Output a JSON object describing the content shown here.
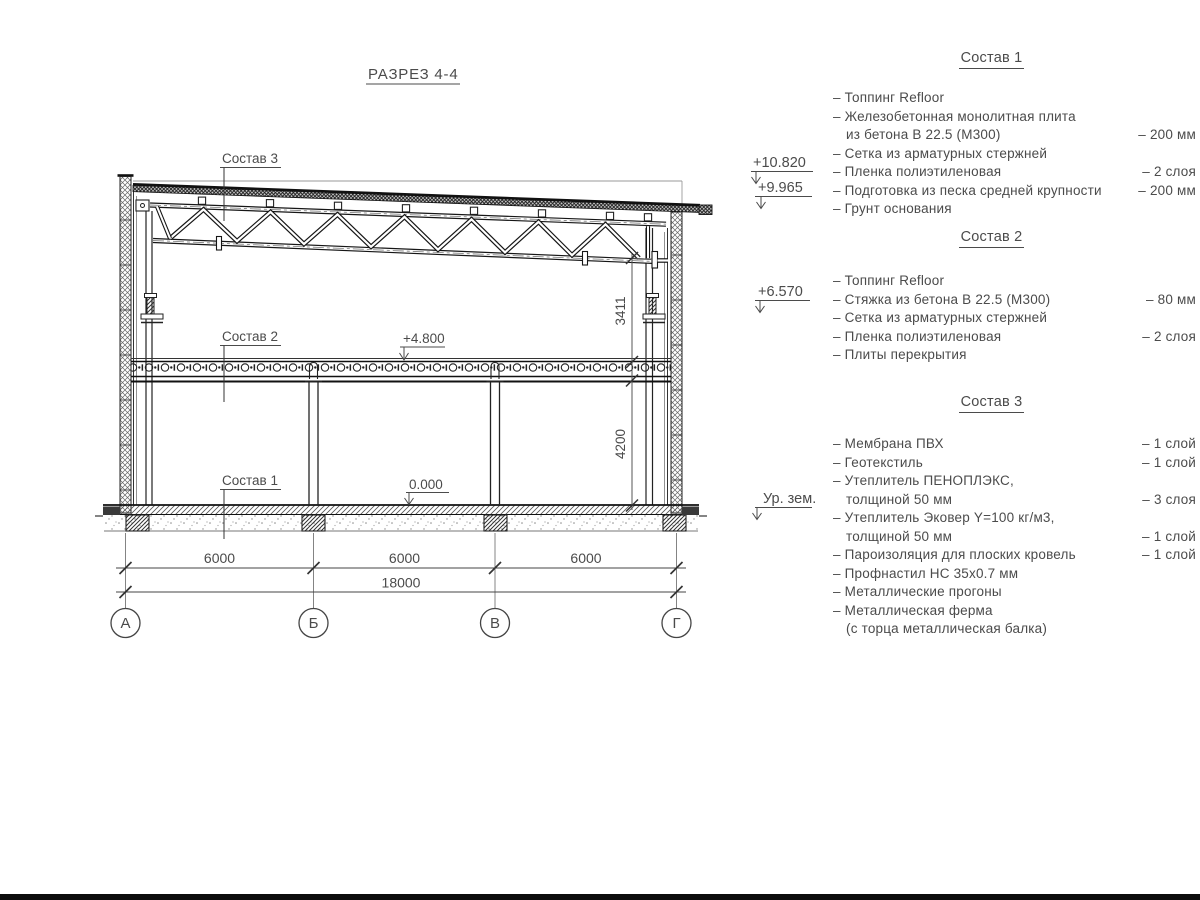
{
  "title": "РАЗРЕЗ 4-4",
  "drawing": {
    "callouts": {
      "sostav3": "Состав 3",
      "sostav2": "Состав 2",
      "sostav1": "Состав 1"
    },
    "elevations": {
      "parapet": "+10.820",
      "roof_edge": "+9.965",
      "console": "+6.570",
      "floor2": "+4.800",
      "floor1": "0.000",
      "ground": "Ур. зем."
    },
    "dims": {
      "span1": "6000",
      "span2": "6000",
      "span3": "6000",
      "total": "18000",
      "h_upper": "3411",
      "h_lower": "4200"
    },
    "axes": [
      "А",
      "Б",
      "В",
      "Г"
    ]
  },
  "lists": [
    {
      "heading": "Состав 1",
      "rows": [
        {
          "l": "– Топпинг Refloor",
          "r": ""
        },
        {
          "l": "– Железобетонная  монолитная плита",
          "r": ""
        },
        {
          "l": "из бетона В 22.5 (М300)",
          "r": "– 200 мм"
        },
        {
          "l": "– Сетка из арматурных стержней",
          "r": ""
        },
        {
          "l": "– Пленка полиэтиленовая",
          "r": "– 2 слоя"
        },
        {
          "l": "– Подготовка из песка средней крупности",
          "r": "– 200 мм"
        },
        {
          "l": "– Грунт основания",
          "r": ""
        }
      ]
    },
    {
      "heading": "Состав 2",
      "rows": [
        {
          "l": "– Топпинг Refloor",
          "r": ""
        },
        {
          "l": "– Стяжка из бетона В 22.5 (М300)",
          "r": "– 80 мм"
        },
        {
          "l": "– Сетка из арматурных стержней",
          "r": ""
        },
        {
          "l": "– Пленка полиэтиленовая",
          "r": "– 2 слоя"
        },
        {
          "l": "– Плиты перекрытия",
          "r": ""
        }
      ]
    },
    {
      "heading": "Состав 3",
      "rows": [
        {
          "l": "– Мембрана ПВХ",
          "r": "– 1 слой"
        },
        {
          "l": "– Геотекстиль",
          "r": "– 1 слой"
        },
        {
          "l": "– Утеплитель ПЕНОПЛЭКС,",
          "r": ""
        },
        {
          "l": "толщиной 50 мм",
          "r": "– 3 слоя"
        },
        {
          "l": "– Утеплитель Эковер Y=100 кг/м3,",
          "r": ""
        },
        {
          "l": "толщиной 50 мм",
          "r": "– 1 слой"
        },
        {
          "l": "– Пароизоляция для плоских кровель",
          "r": "– 1 слой"
        },
        {
          "l": "– Профнастил НС 35х0.7 мм",
          "r": ""
        },
        {
          "l": "– Металлические прогоны",
          "r": ""
        },
        {
          "l": "– Металлическая ферма",
          "r": ""
        },
        {
          "l": "(с торца металлическая балка)",
          "r": ""
        }
      ]
    }
  ]
}
